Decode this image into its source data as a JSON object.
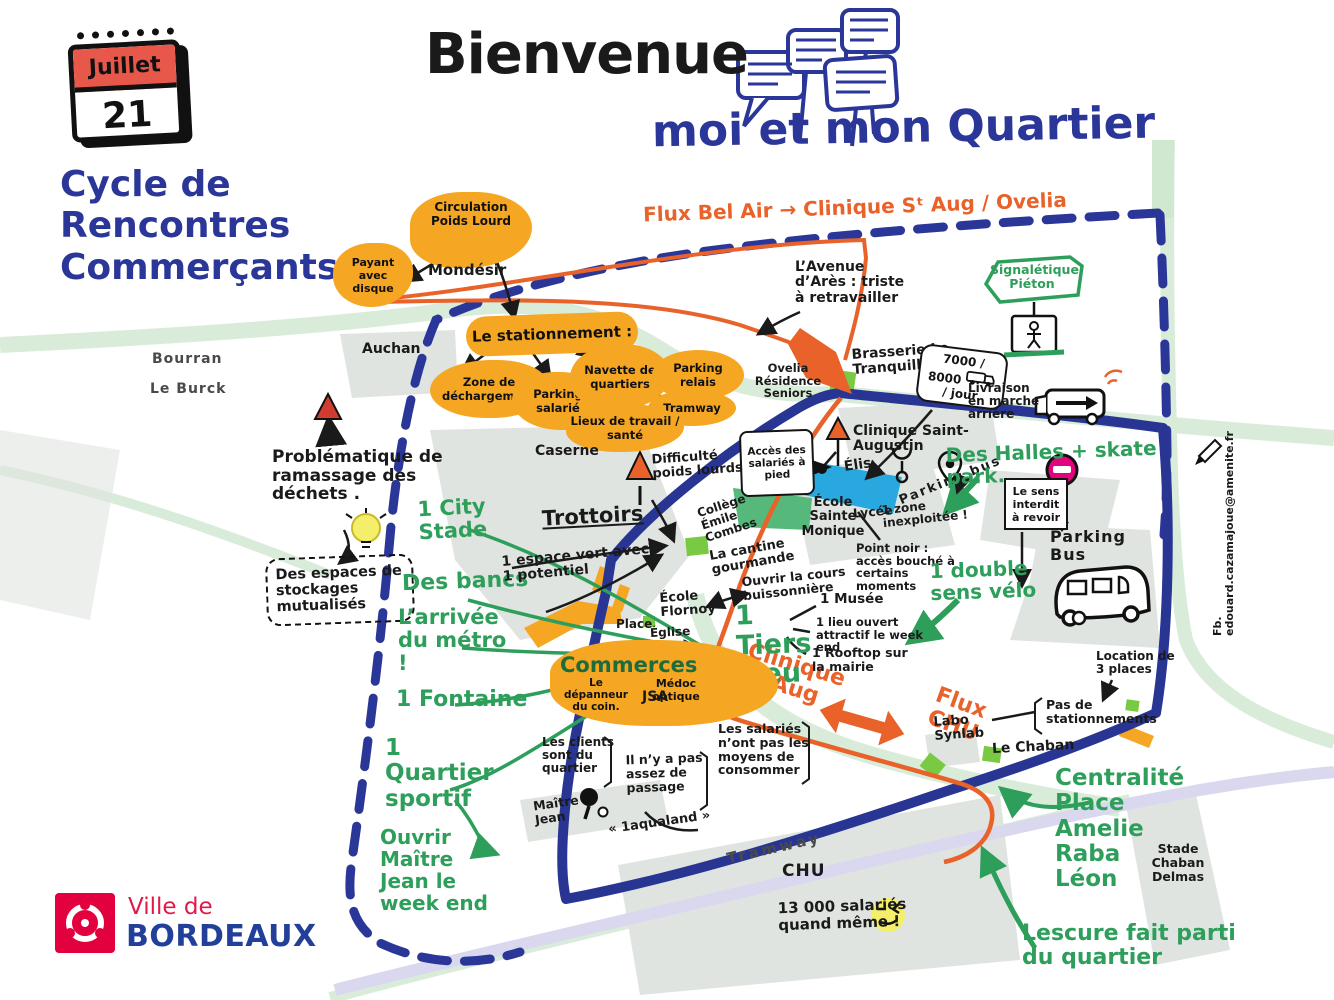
{
  "header": {
    "title": "Bienvenue",
    "subtitle": "moi et mon Quartier",
    "series": "Cycle de Rencontres Commerçants",
    "calendar_month": "Juillet",
    "calendar_day": "21"
  },
  "flux": {
    "bel_air": "Flux Bel Air → Clinique Sᵗ Aug / Ovelia",
    "clinique": "Clinique Sᵗ Aug",
    "chu": "Flux CHU"
  },
  "stationnement": {
    "payant": "Payant avec disque",
    "circulation": "Circulation Poids Lourd",
    "mondesir": "Mondésir",
    "hub": "Le stationnement :",
    "zone": "Zone de déchargement",
    "salarie": "Parking salarié",
    "navette": "Navette de quartiers",
    "relais": "Parking relais",
    "tramway": "Tramway",
    "lieux": "Lieux de travail / santé"
  },
  "places": {
    "bourran": "Bourran",
    "le_burck": "Le Burck",
    "auchan": "Auchan",
    "caserne": "Caserne",
    "trottoirs": "Trottoirs",
    "ovelia": "Ovelia Résidence Seniors",
    "brasserie": "Brasserie Le Tranquille",
    "clinique": "Clinique Saint-Augustin",
    "ecole_monique": "École Sainte Monique",
    "lycee": "Lycée",
    "elis": "Élis",
    "college": "Collège Émile Combes",
    "cantine": "La cantine gourmande",
    "ecole_flornoy": "École Flornoy",
    "place": "Place",
    "eglise": "Église",
    "commerces": "Commerces",
    "depanneur": "Le dépanneur du coin.",
    "medoc": "Médoc optique",
    "jsa": "JSA",
    "maitre_jean": "Maître Jean",
    "aqualand": "« 1aqualand »",
    "labo": "Labo Synlab",
    "le_chaban": "Le Chaban",
    "parking_bus_big": "Parking Bus",
    "chu": "CHU",
    "tramway_line": "Tramway",
    "stade": "Stade Chaban Delmas"
  },
  "notes": {
    "avenue_ares": "L’Avenue d’Arès : triste à retravailler",
    "frequentation": "7000 / 8000",
    "frequentation_unit": "/ jour",
    "livraison": "Livraison en marche arrière",
    "acces_salaries": "Accès des salariés à pied",
    "parking_bus_small": "Parking bus",
    "zone_inexploitee": "1 zone inexploitée !",
    "sens_interdit": "Le sens interdit à revoir",
    "point_noir": "Point noir : accès bouché à certains moments",
    "location": "Location de 3 places",
    "pas_stationnements": "Pas de stationnements",
    "probleme_dechets": "Problématique de ramassage des déchets .",
    "stockages": "Des espaces de stockages mutualisés",
    "espace_vert": "1 espace vert avec 1 potentiel",
    "difficulte": "Difficulté poids lourds",
    "clients": "Les clients sont du quartier",
    "passage": "Il n’y a pas assez de passage",
    "salaries": "Les salariés n’ont pas les moyens de consommer",
    "musee": "1 Musée",
    "lieu_ouvert": "1 lieu ouvert attractif le week end",
    "rooftop": "1 Rooftop sur la mairie",
    "ouvrir_cours": "Ouvrir la cours buissonnière",
    "salaries_chu": "13 000 salariés quand même !"
  },
  "ideas": {
    "signaletique": "Signalétique Piéton",
    "halles": "Des Halles + skate park.",
    "city_stade": "1 City Stade",
    "bancs": "Des bancs",
    "metro": "L’arrivée du métro !",
    "fontaine": "1 Fontaine",
    "quartier_sportif": "1 Quartier sportif",
    "ouvrir_maitre_jean": "Ouvrir Maître Jean le week end",
    "tiers_lieu": "1 Tiers Lieu",
    "double_sens": "1 double sens vélo",
    "centralite": "Centralité Place Amelie Raba Léon",
    "lescure": "Lescure fait parti du quartier"
  },
  "credit": "Fb. edouard.cazamajoue@amenite.fr",
  "logo": {
    "top": "Ville de",
    "bottom": "BORDEAUX"
  },
  "colors": {
    "ink_blue": "#2b3699",
    "orange_fill": "#f5a623",
    "orange_line": "#e8622a",
    "green": "#2e9e5b",
    "calendar_red": "#e8584a",
    "pink": "#e5007e",
    "logo_red": "#e2003f",
    "logo_blue": "#223f99",
    "cyan_building": "#29a8df"
  }
}
